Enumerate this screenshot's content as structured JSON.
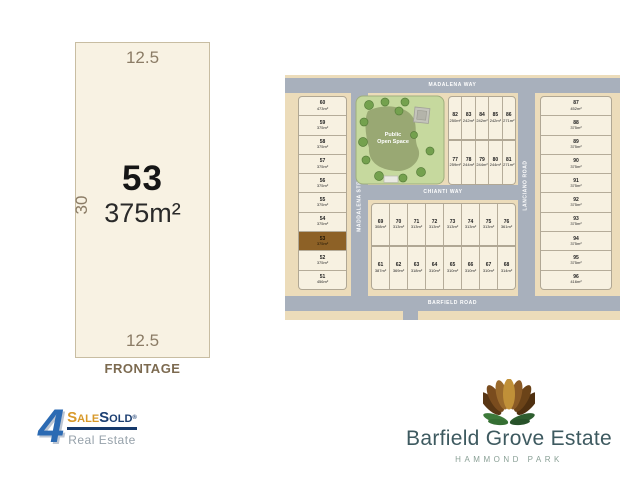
{
  "lot_detail": {
    "width_top": "12.5",
    "depth_left": "30",
    "lot_number": "53",
    "area": "375m²",
    "width_bottom": "12.5",
    "frontage_label": "FRONTAGE"
  },
  "map": {
    "streets": {
      "top": "MADALENA WAY",
      "left_vertical": "MADDALENA STREET",
      "middle": "CHIANTI WAY",
      "right_vertical": "LANCIANO ROAD",
      "bottom": "BARFIELD ROAD"
    },
    "park_label_line1": "Public",
    "park_label_line2": "Open Space",
    "highlighted_lot": "53",
    "highlight_color": "#8d6126",
    "road_color": "#a8b0bc",
    "block_color": "#ecdcba",
    "lot_color": "#f7f1e1",
    "blocks": {
      "west_column": [
        {
          "lot": "60",
          "area": "473m²"
        },
        {
          "lot": "59",
          "area": "375m²"
        },
        {
          "lot": "58",
          "area": "375m²"
        },
        {
          "lot": "57",
          "area": "375m²"
        },
        {
          "lot": "56",
          "area": "375m²"
        },
        {
          "lot": "55",
          "area": "375m²"
        },
        {
          "lot": "54",
          "area": "375m²"
        },
        {
          "lot": "53",
          "area": "375m²"
        },
        {
          "lot": "52",
          "area": "375m²"
        },
        {
          "lot": "51",
          "area": "456m²"
        }
      ],
      "north_block_row1": [
        {
          "lot": "82",
          "area": "250m²"
        },
        {
          "lot": "83",
          "area": "242m²"
        },
        {
          "lot": "84",
          "area": "242m²"
        },
        {
          "lot": "85",
          "area": "242m²"
        },
        {
          "lot": "86",
          "area": "271m²"
        }
      ],
      "north_block_row2": [
        {
          "lot": "77",
          "area": "259m²"
        },
        {
          "lot": "78",
          "area": "244m²"
        },
        {
          "lot": "79",
          "area": "244m²"
        },
        {
          "lot": "80",
          "area": "244m²"
        },
        {
          "lot": "81",
          "area": "271m²"
        }
      ],
      "central_block_row1": [
        {
          "lot": "69",
          "area": "308m²"
        },
        {
          "lot": "70",
          "area": "313m²"
        },
        {
          "lot": "71",
          "area": "313m²"
        },
        {
          "lot": "72",
          "area": "313m²"
        },
        {
          "lot": "73",
          "area": "313m²"
        },
        {
          "lot": "74",
          "area": "313m²"
        },
        {
          "lot": "75",
          "area": "313m²"
        },
        {
          "lot": "76",
          "area": "361m²"
        }
      ],
      "central_block_row2": [
        {
          "lot": "61",
          "area": "387m²"
        },
        {
          "lot": "62",
          "area": "369m²"
        },
        {
          "lot": "63",
          "area": "318m²"
        },
        {
          "lot": "64",
          "area": "310m²"
        },
        {
          "lot": "65",
          "area": "310m²"
        },
        {
          "lot": "66",
          "area": "310m²"
        },
        {
          "lot": "67",
          "area": "310m²"
        },
        {
          "lot": "68",
          "area": "314m²"
        }
      ],
      "east_column": [
        {
          "lot": "87",
          "area": "452m²"
        },
        {
          "lot": "88",
          "area": "375m²"
        },
        {
          "lot": "89",
          "area": "375m²"
        },
        {
          "lot": "90",
          "area": "375m²"
        },
        {
          "lot": "91",
          "area": "375m²"
        },
        {
          "lot": "92",
          "area": "375m²"
        },
        {
          "lot": "93",
          "area": "375m²"
        },
        {
          "lot": "94",
          "area": "375m²"
        },
        {
          "lot": "95",
          "area": "375m²"
        },
        {
          "lot": "96",
          "area": "416m²"
        }
      ]
    }
  },
  "logos": {
    "agency": {
      "four": "4",
      "sale_initial": "S",
      "sale_rest": "ALE",
      "sold_initial": "S",
      "sold_rest": "OLD",
      "reg": "®",
      "tagline": "Real Estate",
      "gold": "#d8992a",
      "navy": "#16396b",
      "blue": "#2b6ab3"
    },
    "estate": {
      "name": "Barfield Grove Estate",
      "suburb": "HAMMOND PARK",
      "name_color": "#3e5a60"
    }
  }
}
